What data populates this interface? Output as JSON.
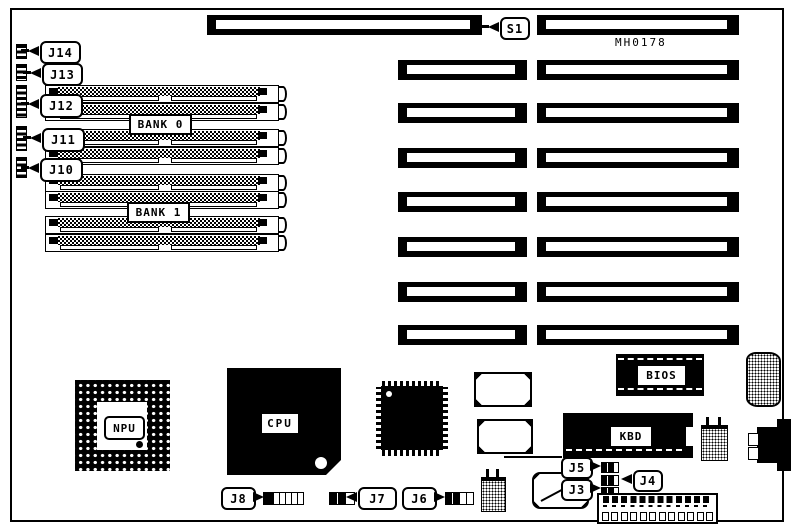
{
  "labels": {
    "part_number": "MH0178",
    "s1": "S1",
    "j3": "J3",
    "j4": "J4",
    "j5": "J5",
    "j6": "J6",
    "j7": "J7",
    "j8": "J8",
    "j10": "J10",
    "j11": "J11",
    "j12": "J12",
    "j13": "J13",
    "j14": "J14",
    "bank0": "BANK 0",
    "bank1": "BANK 1",
    "npu": "NPU",
    "cpu": "CPU",
    "bios": "BIOS",
    "kbd": "KBD"
  },
  "components": {
    "expansion_slots": {
      "top_long_slot_count": 1,
      "left_column_count": 7,
      "right_column_count": 8
    },
    "simm_sockets": {
      "count": 8,
      "banks": [
        "BANK 0",
        "BANK 1"
      ]
    },
    "power_connector": {
      "pin_count": 12
    },
    "jumper_callouts": [
      "S1",
      "J3",
      "J4",
      "J5",
      "J6",
      "J7",
      "J8",
      "J10",
      "J11",
      "J12",
      "J13",
      "J14"
    ],
    "chips": [
      "NPU",
      "CPU",
      "BIOS",
      "KBD"
    ]
  },
  "colors": {
    "line": "#000000",
    "background": "#ffffff"
  }
}
